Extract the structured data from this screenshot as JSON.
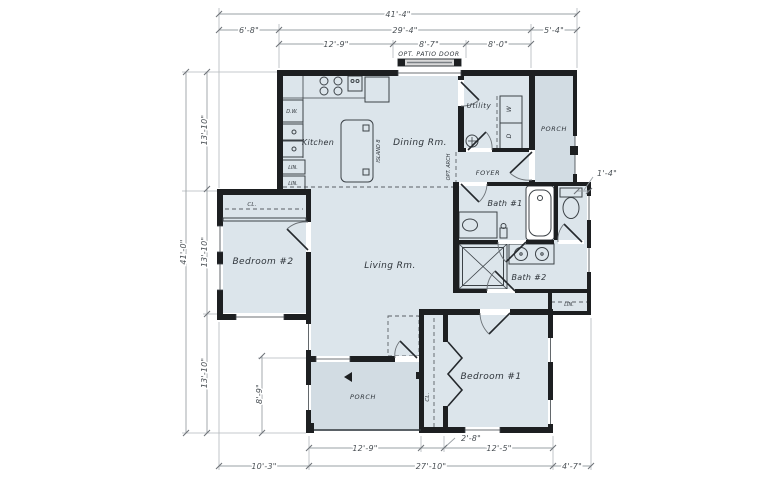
{
  "plan": {
    "rooms": {
      "kitchen": "Kitchen",
      "dining": "Dining Rm.",
      "living": "Living Rm.",
      "bedroom2": "Bedroom #2",
      "bedroom1": "Bedroom #1",
      "bath1": "Bath #1",
      "bath2": "Bath #2",
      "utility": "Utility",
      "foyer": "FOYER",
      "porch_upper": "PORCH",
      "porch_lower": "PORCH"
    },
    "fixtures": {
      "island": "ISLAND 8",
      "dishwasher": "D.W.",
      "washer": "W",
      "dryer": "D",
      "linen_kitchen_1": "LIN.",
      "linen_kitchen_2": "LIN.",
      "linen_bath": "LIN.",
      "closet_bedroom2": "CL.",
      "closet_bedroom1": "CL.",
      "opt_patio_door": "OPT. PATIO DOOR",
      "opt_arch": "OPT. ARCH"
    },
    "dims": {
      "top_overall": "41'-4\"",
      "top_left": "6'-8\"",
      "top_mid": "29'-4\"",
      "top_right": "5'-4\"",
      "top_sub_left": "12'-9\"",
      "top_sub_mid": "8'-7\"",
      "top_sub_right": "8'-0\"",
      "left_overall": "41'-0\"",
      "left_seg1": "13'-10\"",
      "left_seg2": "13'-10\"",
      "left_seg3": "13'-10\"",
      "left_porch": "8'-9\"",
      "right_offset": "1'-4\"",
      "bot_porch": "12'-9\"",
      "bot_closet": "2'-8\"",
      "bot_bedroom": "12'-5\"",
      "bot_left": "10'-3\"",
      "bot_mid": "27'-10\"",
      "bot_right": "4'-7\""
    },
    "colors": {
      "room_fill": "#dce5eb",
      "porch_fill": "#d2dce3",
      "wall": "#1d1f21",
      "dim_line": "#9aa0a5",
      "ink": "#33393e"
    }
  }
}
